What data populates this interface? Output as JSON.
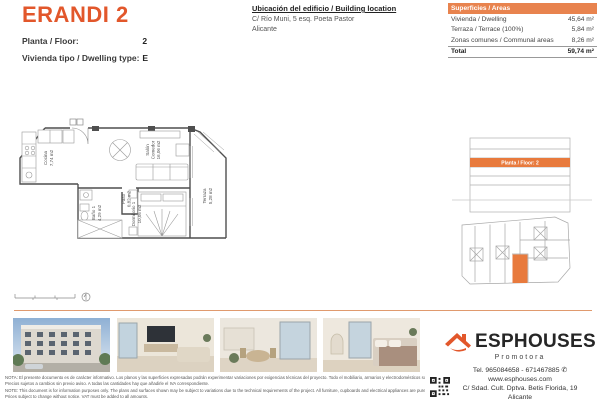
{
  "header": {
    "title": "ERANDI 2",
    "floor_label": "Planta / Floor:",
    "floor_value": "2",
    "dwelling_label": "Vivienda tipo / Dwelling type:",
    "dwelling_value": "E",
    "location_title": "Ubicación del edificio / Building location",
    "location_line1": "C/ Río Muni, 5 esq. Poeta Pastor",
    "location_line2": "Alicante"
  },
  "areas_table": {
    "header": "Superficies / Areas",
    "rows": [
      {
        "label": "Vivienda / Dwelling",
        "value": "45,64 m²"
      },
      {
        "label": "Terraza / Terrace (100%)",
        "value": "5,84 m²"
      },
      {
        "label": "Zonas comunes / Communal areas",
        "value": "8,26 m²"
      }
    ],
    "total_label": "Total",
    "total_value": "59,74 m²"
  },
  "floor_plan": {
    "rooms": {
      "cocina": {
        "name": "Cocina",
        "area": "7,74 m2"
      },
      "salon": {
        "name_line1": "Salón",
        "name_line2": "Comedor",
        "area": "16,06 m2"
      },
      "bano": {
        "name": "Baño 1",
        "area": "4,29 m2"
      },
      "paso": {
        "name": "Paso",
        "area": "0,82 m2"
      },
      "dormitorio": {
        "name": "Dormitorio 1",
        "area": "10,05 m2"
      },
      "terraza": {
        "name": "Terraza",
        "area": "5,28 m2"
      }
    }
  },
  "elevation": {
    "highlight_label": "Planta / Floor: 2"
  },
  "footer": {
    "brand": "ESPHOUSES",
    "brand_sub": "Promotora",
    "tel": "Tel. 965084658 - 671467885",
    "phone_icon": "✆",
    "web": "www.esphouses.com",
    "address": "C/ Sdad. Cult. Dptva. Betis Florida, 19",
    "city": "Alicante",
    "disclaimer_es1": "NOTA: El presente documento es de carácter informativo. Los planos y las superficies expresadas podrán experimentar variaciones por exigencias técnicas del proyecto. Todo el mobiliario, armarios y electrodomésticos son meramente decorativos.",
    "disclaimer_es2": "Precios sujetos a cambios sin previo aviso. A todas las cantidades hay que añadirle el IVA correspondiente.",
    "disclaimer_en1": "NOTE: This document is for information purposes only. The plans and surfaces shown may be subject to variations due to the technical requirements of the project. All furniture, cupboards and electrical appliances are purely decorative.",
    "disclaimer_en2": "Prices subject to change without notice. VAT must be added to all amounts."
  },
  "colors": {
    "accent": "#e2572b",
    "table_header_bg": "#e8834e",
    "highlight_band": "#e87a3d"
  }
}
